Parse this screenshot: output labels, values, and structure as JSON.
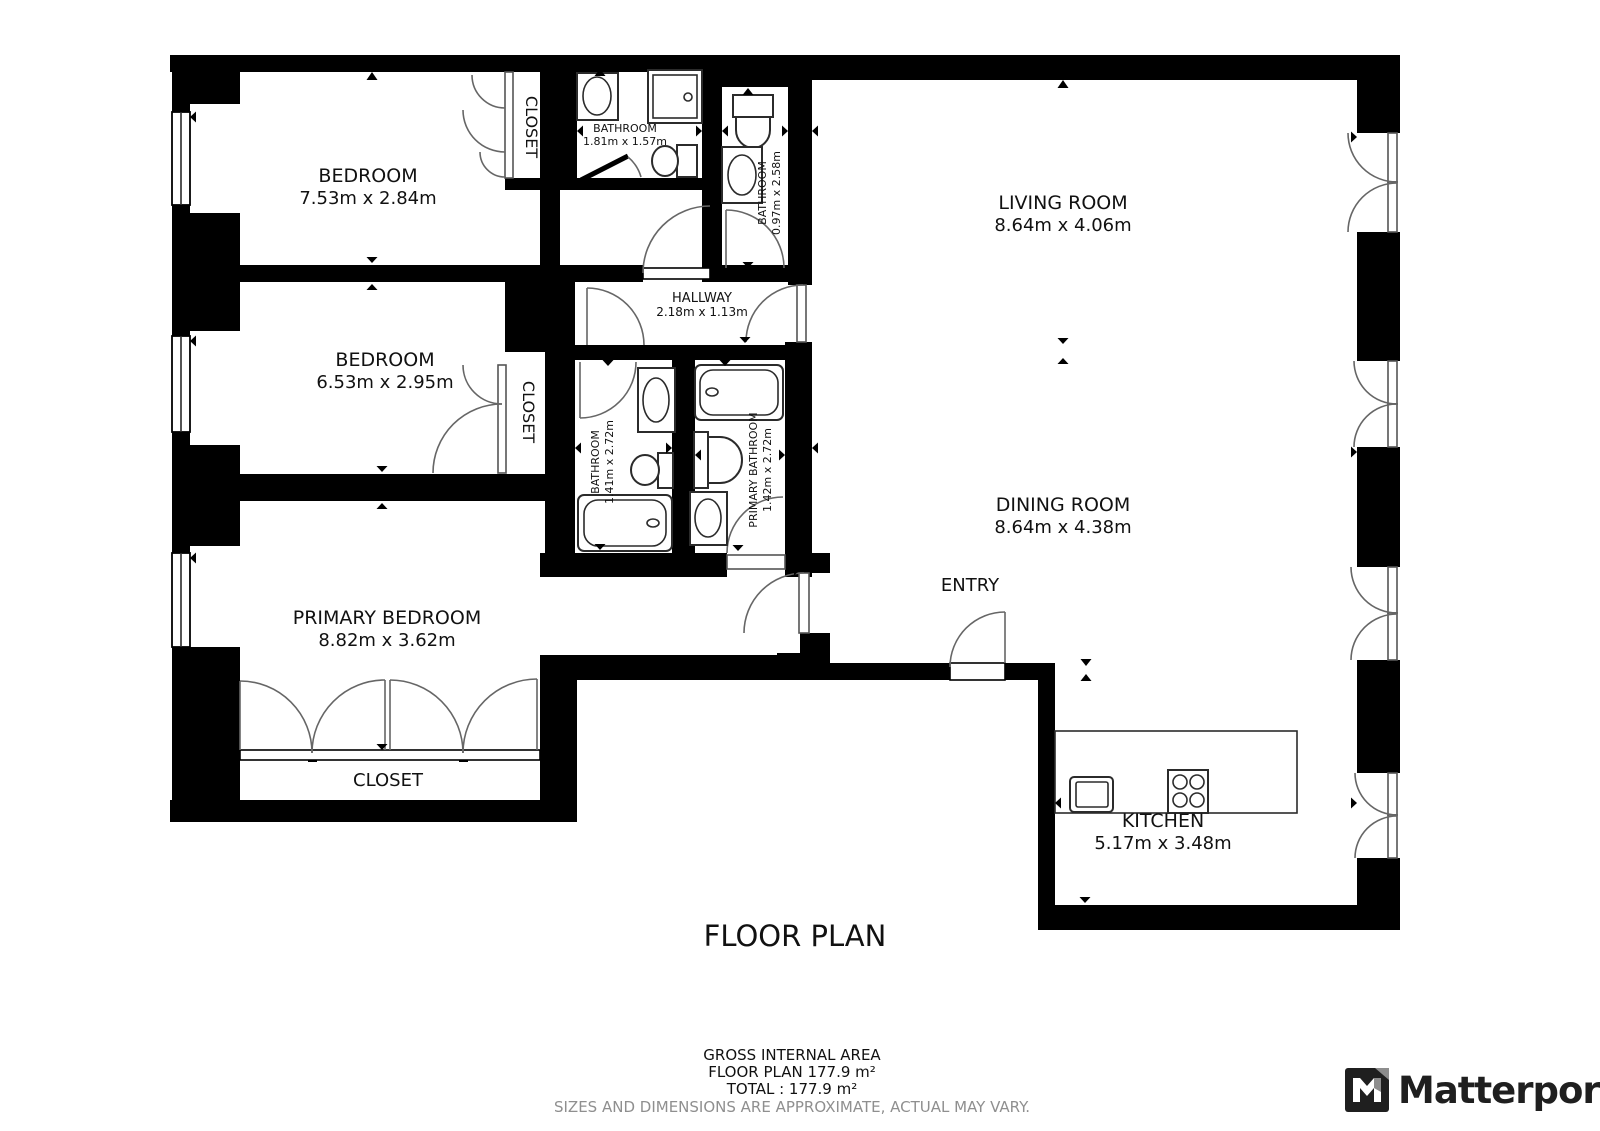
{
  "title": "FLOOR PLAN",
  "rooms": {
    "bedroom1": {
      "name": "BEDROOM",
      "dims": "7.53m x 2.84m"
    },
    "bedroom2": {
      "name": "BEDROOM",
      "dims": "6.53m x 2.95m"
    },
    "primary_bedroom": {
      "name": "PRIMARY BEDROOM",
      "dims": "8.82m x 3.62m"
    },
    "living_room": {
      "name": "LIVING ROOM",
      "dims": "8.64m x 4.06m"
    },
    "dining_room": {
      "name": "DINING ROOM",
      "dims": "8.64m x 4.38m"
    },
    "kitchen": {
      "name": "KITCHEN",
      "dims": "5.17m x 3.48m"
    },
    "hallway": {
      "name": "HALLWAY",
      "dims": "2.18m x 1.13m"
    },
    "entry": {
      "name": "ENTRY"
    },
    "bathroom_top": {
      "name": "BATHROOM",
      "dims": "1.81m x 1.57m"
    },
    "bathroom_right": {
      "name": "BATHROOM",
      "dims": "0.97m x 2.58m"
    },
    "bathroom_mid": {
      "name": "BATHROOM",
      "dims": "1.41m x 2.72m"
    },
    "primary_bathroom": {
      "name": "PRIMARY BATHROOM",
      "dims": "1.42m x 2.72m"
    },
    "closet_top": {
      "name": "CLOSET"
    },
    "closet_mid": {
      "name": "CLOSET"
    },
    "closet_primary": {
      "name": "CLOSET"
    }
  },
  "footer": {
    "gross": "GROSS INTERNAL AREA",
    "floor_plan_area": "FLOOR PLAN 177.9 m²",
    "total": "TOTAL :  177.9 m²",
    "disclaimer": "SIZES AND DIMENSIONS ARE APPROXIMATE, ACTUAL MAY VARY."
  },
  "branding": {
    "logo_text": "Matterport"
  },
  "colors": {
    "wall": "#000000",
    "background": "#ffffff",
    "disclaimer_text": "#8f8f8f",
    "logo": "#1f1f1f"
  }
}
